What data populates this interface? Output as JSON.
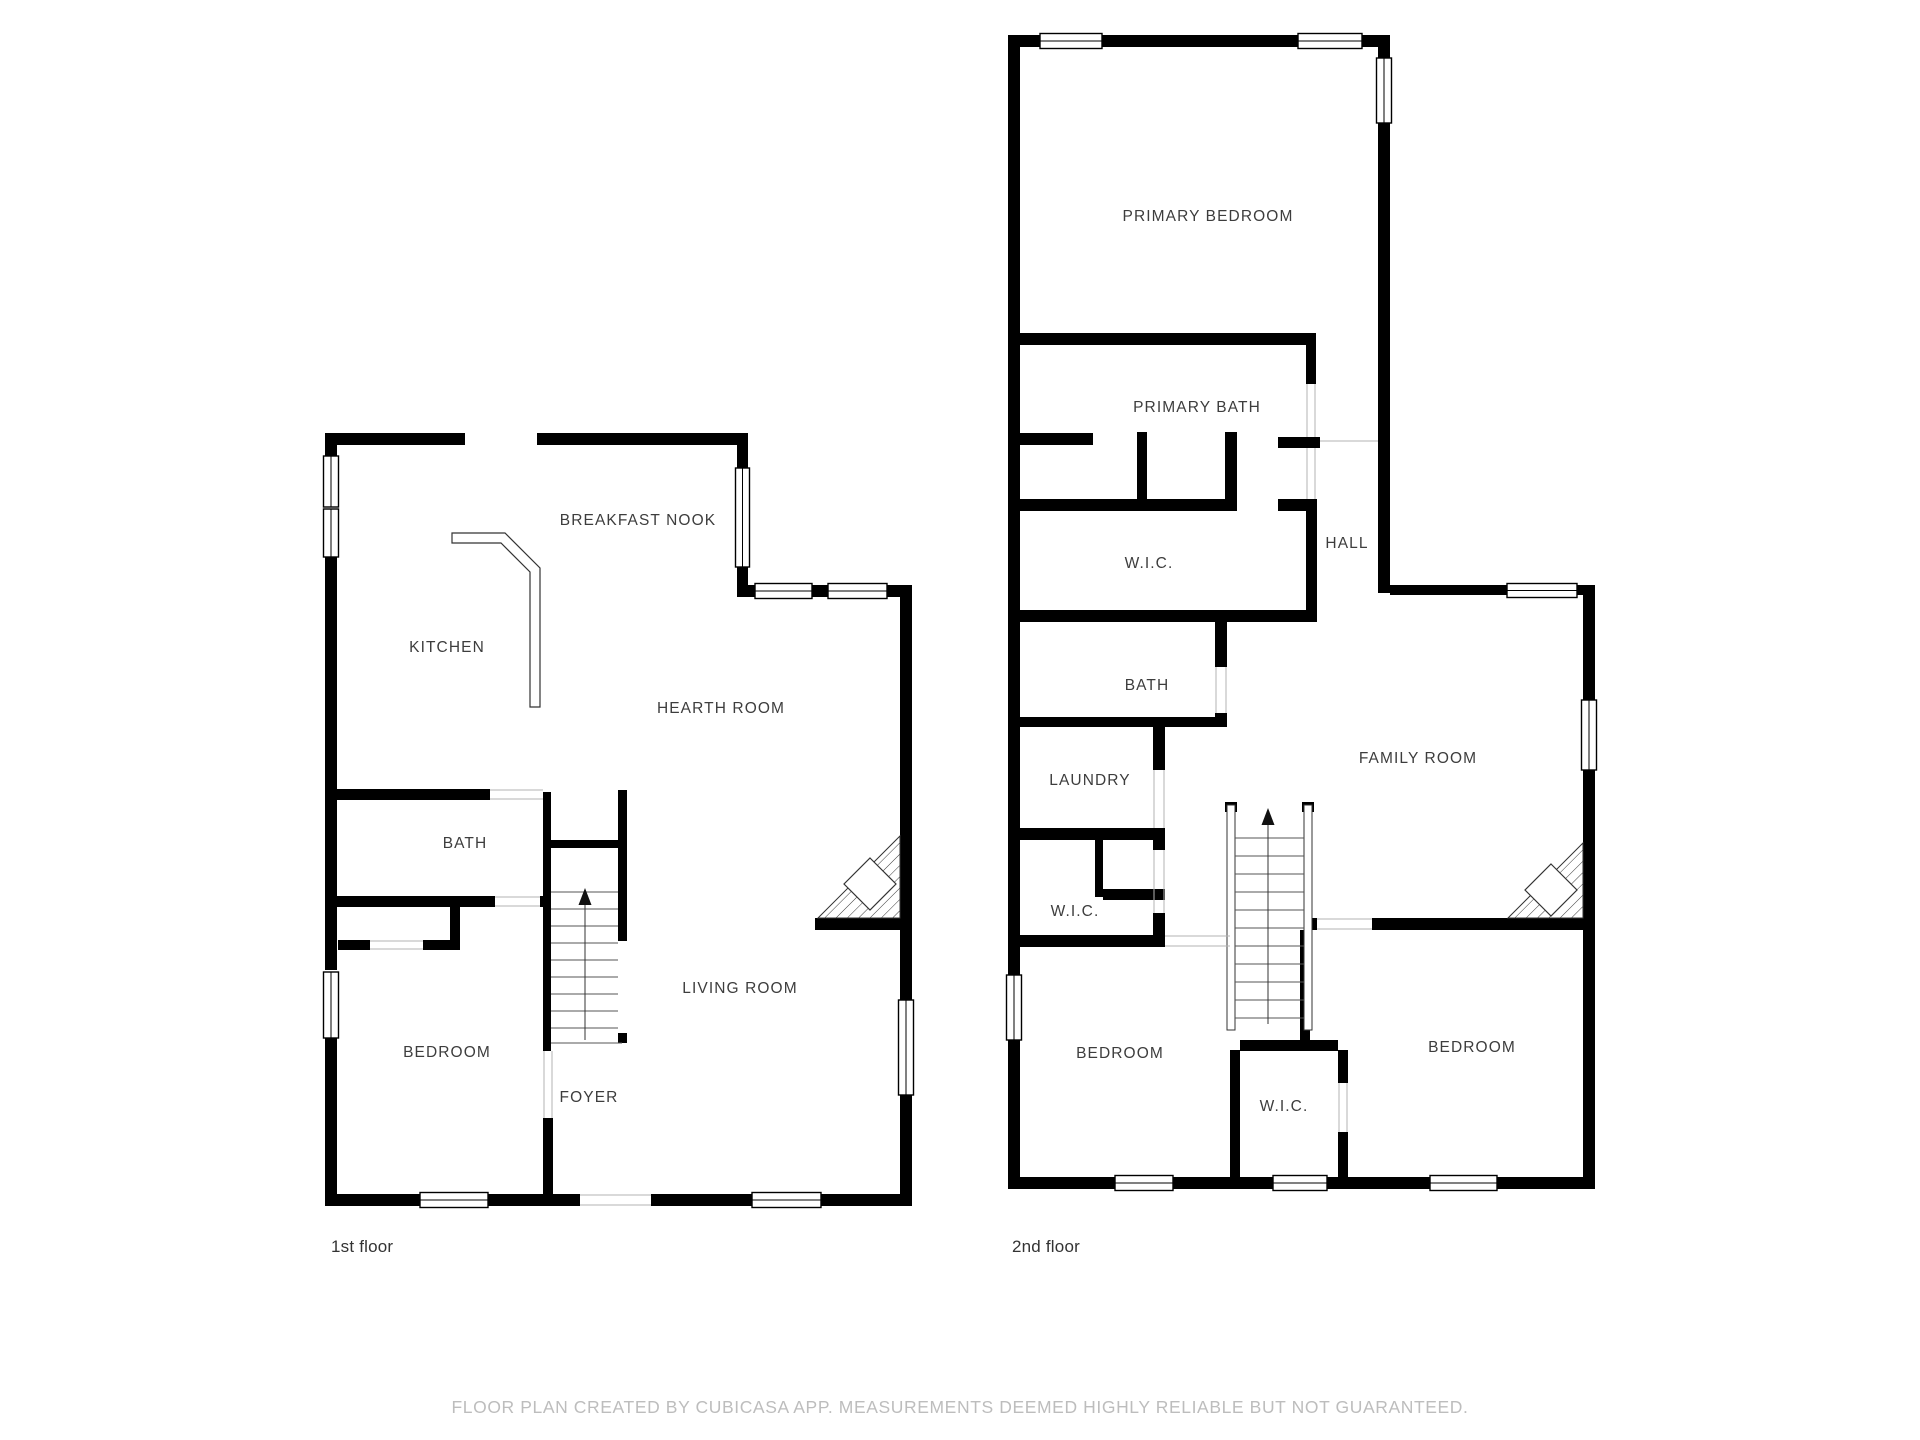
{
  "colors": {
    "background": "#ffffff",
    "walls": "#000000",
    "room_label": "#3d3d3d",
    "floor_label": "#333333",
    "disclaimer": "#bdbdbd",
    "stair_lines": "#555555",
    "door_lines": "#b3b3b3"
  },
  "floors": [
    {
      "label": "1st floor",
      "rooms": [
        "BREAKFAST NOOK",
        "KITCHEN",
        "HEARTH ROOM",
        "BATH",
        "BEDROOM",
        "FOYER",
        "LIVING ROOM"
      ]
    },
    {
      "label": "2nd floor",
      "rooms": [
        "PRIMARY BEDROOM",
        "PRIMARY BATH",
        "W.I.C.",
        "HALL",
        "BATH",
        "LAUNDRY",
        "FAMILY ROOM",
        "W.I.C.",
        "BEDROOM",
        "W.I.C.",
        "BEDROOM"
      ]
    }
  ],
  "footer": {
    "disclaimer": "FLOOR PLAN CREATED BY CUBICASA APP. MEASUREMENTS DEEMED HIGHLY RELIABLE BUT NOT GUARANTEED."
  }
}
